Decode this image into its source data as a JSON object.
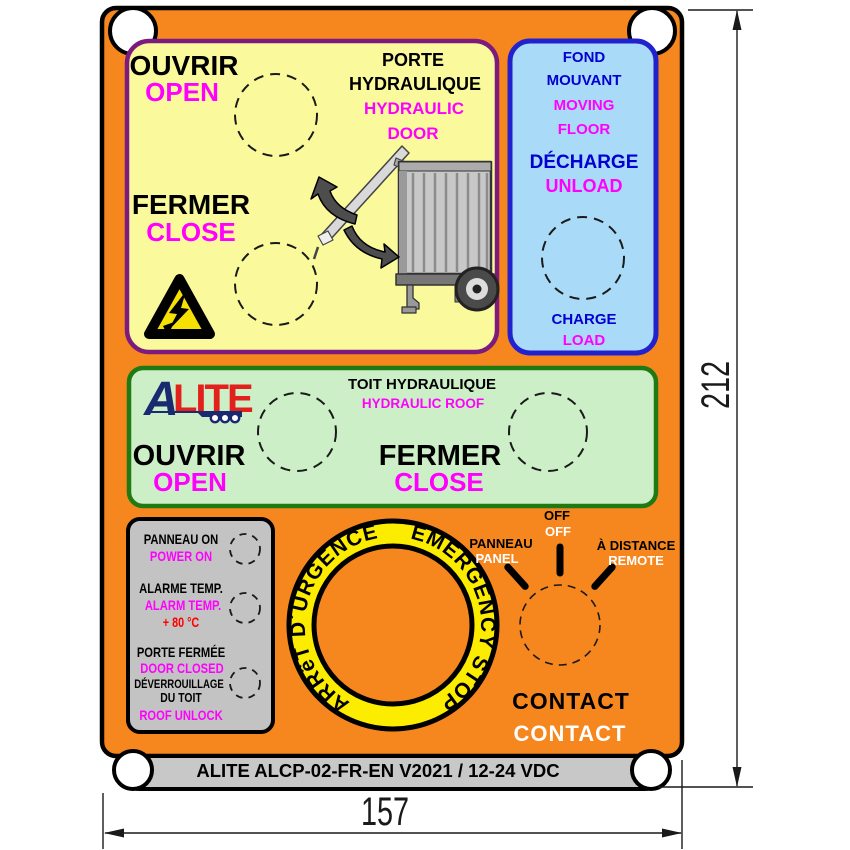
{
  "door_panel": {
    "title_fr_1": "PORTE",
    "title_fr_2": "HYDRAULIQUE",
    "title_en_1": "HYDRAULIC",
    "title_en_2": "DOOR",
    "open_fr": "OUVRIR",
    "open_en": "OPEN",
    "close_fr": "FERMER",
    "close_en": "CLOSE"
  },
  "floor_panel": {
    "title_fr_1": "FOND",
    "title_fr_2": "MOUVANT",
    "title_en_1": "MOVING",
    "title_en_2": "FLOOR",
    "unload_fr": "DÉCHARGE",
    "unload_en": "UNLOAD",
    "load_fr": "CHARGE",
    "load_en": "LOAD"
  },
  "roof_panel": {
    "title_fr": "TOIT HYDRAULIQUE",
    "title_en": "HYDRAULIC ROOF",
    "open_fr": "OUVRIR",
    "open_en": "OPEN",
    "close_fr": "FERMER",
    "close_en": "CLOSE"
  },
  "logo": {
    "a": "A",
    "lite": "LITE"
  },
  "indicators": {
    "power_fr": "PANNEAU ON",
    "power_en": "POWER ON",
    "alarm_fr": "ALARME TEMP.",
    "alarm_en": "ALARM TEMP.",
    "alarm_value": "+ 80 °C",
    "door_fr": "PORTE FERMÉE",
    "door_en": "DOOR CLOSED",
    "unlock_fr_1": "DÉVERROUILLAGE",
    "unlock_fr_2": "DU TOIT",
    "unlock_en": "ROOF UNLOCK"
  },
  "estop": {
    "label_fr": "ARRêT D´URGENCE",
    "label_en": "EMERGENCY STOP"
  },
  "selector": {
    "panel_fr": "PANNEAU",
    "panel_en": "PANEL",
    "off_fr": "OFF",
    "off_en": "OFF",
    "remote_fr": "À DISTANCE",
    "remote_en": "REMOTE"
  },
  "contact": {
    "fr": "CONTACT",
    "en": "CONTACT"
  },
  "footer": {
    "label": "ALITE ALCP-02-FR-EN V2021 / 12-24 VDC"
  },
  "dimensions": {
    "height_mm": "212",
    "width_mm": "157"
  },
  "colors": {
    "plate_orange": "#F6861E",
    "door_panel_fill": "#FAFA9C",
    "door_panel_border": "#7D1A7D",
    "floor_panel_fill": "#A9DAF8",
    "floor_panel_border": "#2121CE",
    "floor_text_blue": "#0000D2",
    "roof_panel_fill": "#CDEFC8",
    "roof_panel_border": "#1F7A14",
    "indicator_panel_fill": "#C3C3C3",
    "footer_strip_fill": "#C8C8C8",
    "estop_yellow": "#FCEC00",
    "magenta": "#FF00FF",
    "alarm_red": "#FF0000",
    "logo_navy": "#1A2A70",
    "logo_red": "#E3211C"
  }
}
